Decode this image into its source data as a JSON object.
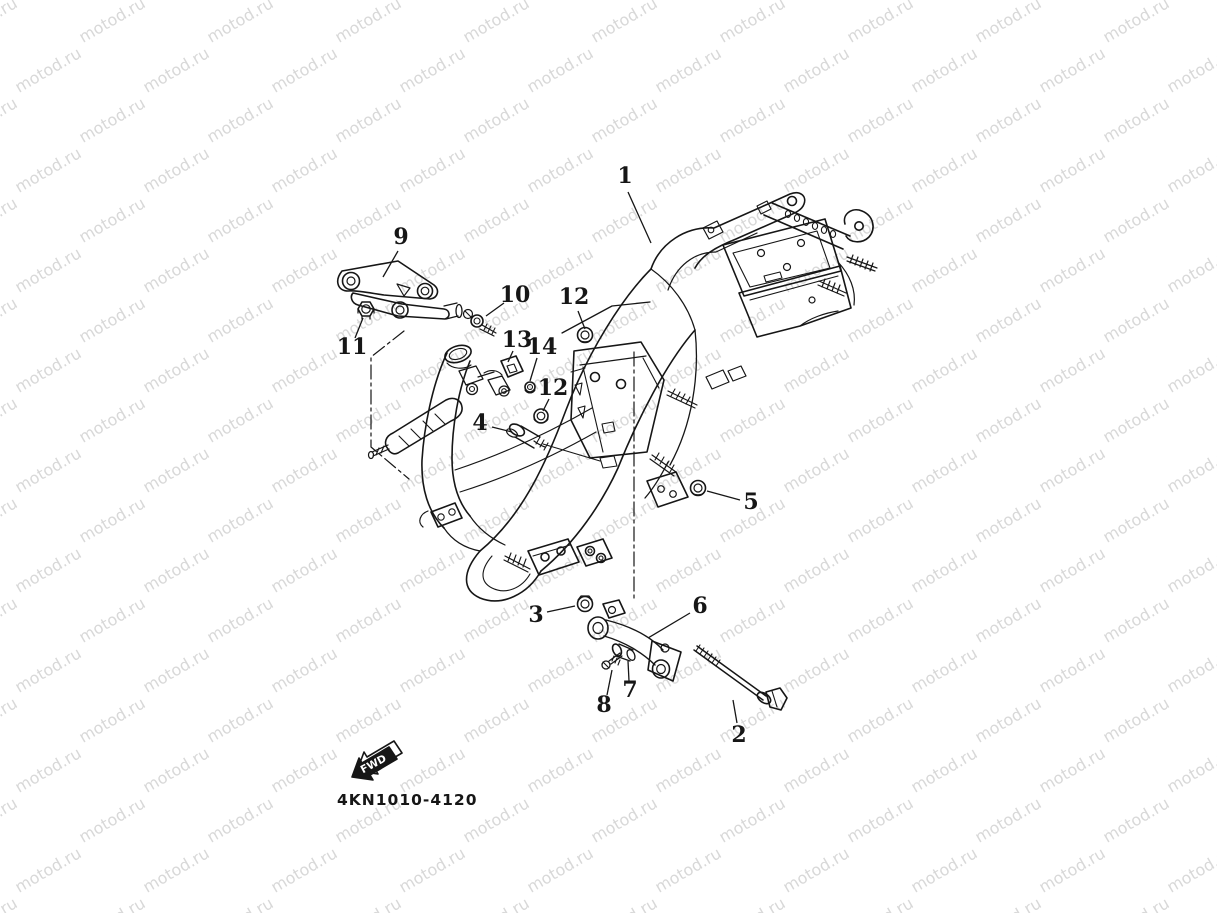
{
  "canvas": {
    "width": 1217,
    "height": 913,
    "background": "#ffffff"
  },
  "watermark": {
    "text": "motod.ru",
    "color": "#d8d8d8",
    "font_size_px": 16,
    "rotation_deg": -30,
    "col_spacing_px": 128,
    "row_spacing_px": 50,
    "odd_row_offset_px": 64
  },
  "diagram": {
    "line_color": "#161616",
    "drawing_code": "4KN1010-4120",
    "fwd_arrow": {
      "label": "FWD"
    },
    "callout_font_px": 22,
    "callouts": [
      {
        "id": "1",
        "label": "1",
        "tx": 625,
        "ty": 183,
        "x1": 628,
        "y1": 192,
        "x2": 651,
        "y2": 243
      },
      {
        "id": "2",
        "label": "2",
        "tx": 739,
        "ty": 742,
        "x1": 737,
        "y1": 723,
        "x2": 733,
        "y2": 700
      },
      {
        "id": "3",
        "label": "3",
        "tx": 536,
        "ty": 622,
        "x1": 547,
        "y1": 612,
        "x2": 575,
        "y2": 606
      },
      {
        "id": "4",
        "label": "4",
        "tx": 480,
        "ty": 430,
        "x1": 492,
        "y1": 427,
        "x2": 512,
        "y2": 432
      },
      {
        "id": "5",
        "label": "5",
        "tx": 751,
        "ty": 509,
        "x1": 740,
        "y1": 500,
        "x2": 707,
        "y2": 491
      },
      {
        "id": "6",
        "label": "6",
        "tx": 700,
        "ty": 613,
        "x1": 690,
        "y1": 613,
        "x2": 648,
        "y2": 638
      },
      {
        "id": "7",
        "label": "7",
        "tx": 630,
        "ty": 697,
        "x1": 629,
        "y1": 681,
        "x2": 628,
        "y2": 661
      },
      {
        "id": "8",
        "label": "8",
        "tx": 604,
        "ty": 712,
        "x1": 607,
        "y1": 695,
        "x2": 612,
        "y2": 670
      },
      {
        "id": "9",
        "label": "9",
        "tx": 401,
        "ty": 244,
        "x1": 398,
        "y1": 251,
        "x2": 383,
        "y2": 277
      },
      {
        "id": "10",
        "label": "10",
        "tx": 515,
        "ty": 302,
        "x1": 504,
        "y1": 303,
        "x2": 486,
        "y2": 316
      },
      {
        "id": "11",
        "label": "11",
        "tx": 352,
        "ty": 354,
        "x1": 355,
        "y1": 338,
        "x2": 363,
        "y2": 318
      },
      {
        "id": "12a",
        "label": "12",
        "tx": 574,
        "ty": 304,
        "x1": 578,
        "y1": 311,
        "x2": 585,
        "y2": 329
      },
      {
        "id": "13",
        "label": "13",
        "tx": 517,
        "ty": 347,
        "x1": 513,
        "y1": 351,
        "x2": 508,
        "y2": 362
      },
      {
        "id": "14",
        "label": "14",
        "tx": 542,
        "ty": 354,
        "x1": 537,
        "y1": 358,
        "x2": 530,
        "y2": 381
      },
      {
        "id": "12b",
        "label": "12",
        "tx": 553,
        "ty": 395,
        "x1": 549,
        "y1": 399,
        "x2": 543,
        "y2": 411
      }
    ]
  }
}
